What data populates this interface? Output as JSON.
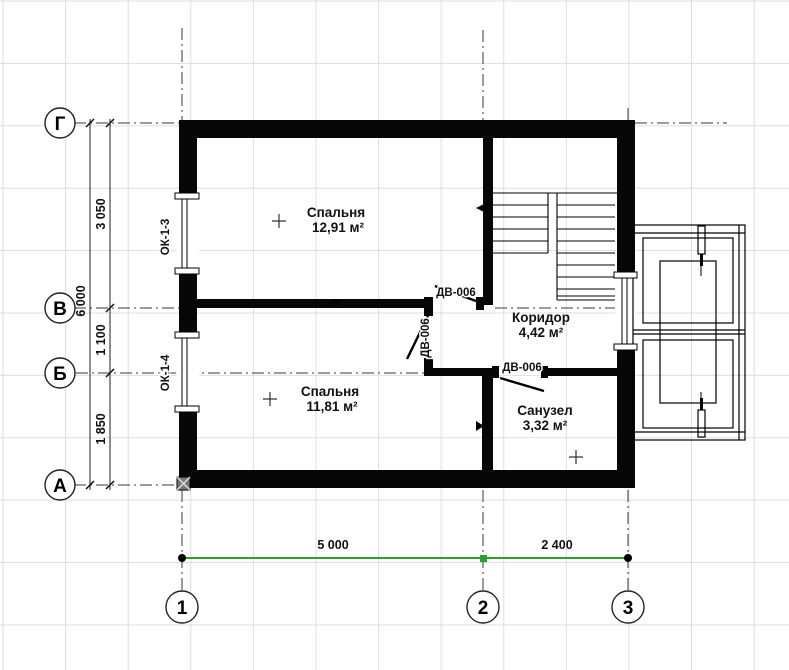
{
  "axes": {
    "rows": [
      {
        "label": "Г"
      },
      {
        "label": "В"
      },
      {
        "label": "Б"
      },
      {
        "label": "А"
      }
    ],
    "cols": [
      {
        "label": "1"
      },
      {
        "label": "2"
      },
      {
        "label": "3"
      }
    ]
  },
  "dimensions": {
    "left_total": "6 000",
    "left_segments": [
      "3 050",
      "1 100",
      "1 850"
    ],
    "bottom_segments": [
      "5 000",
      "2 400"
    ]
  },
  "rooms": [
    {
      "name": "Спальня",
      "area": "12,91 м²"
    },
    {
      "name": "Спальня",
      "area": "11,81 м²"
    },
    {
      "name": "Коридор",
      "area": "4,42 м²"
    },
    {
      "name": "Санузел",
      "area": "3,32 м²"
    }
  ],
  "tags": {
    "windows": [
      "ОК-1-3",
      "ОК-1-4"
    ],
    "doors": [
      "ДВ-006",
      "ДВ-006",
      "ДВ-006"
    ]
  },
  "colors": {
    "linework": "#000000",
    "grid": "#dedede",
    "selected_dimension": "#2ca02c"
  }
}
